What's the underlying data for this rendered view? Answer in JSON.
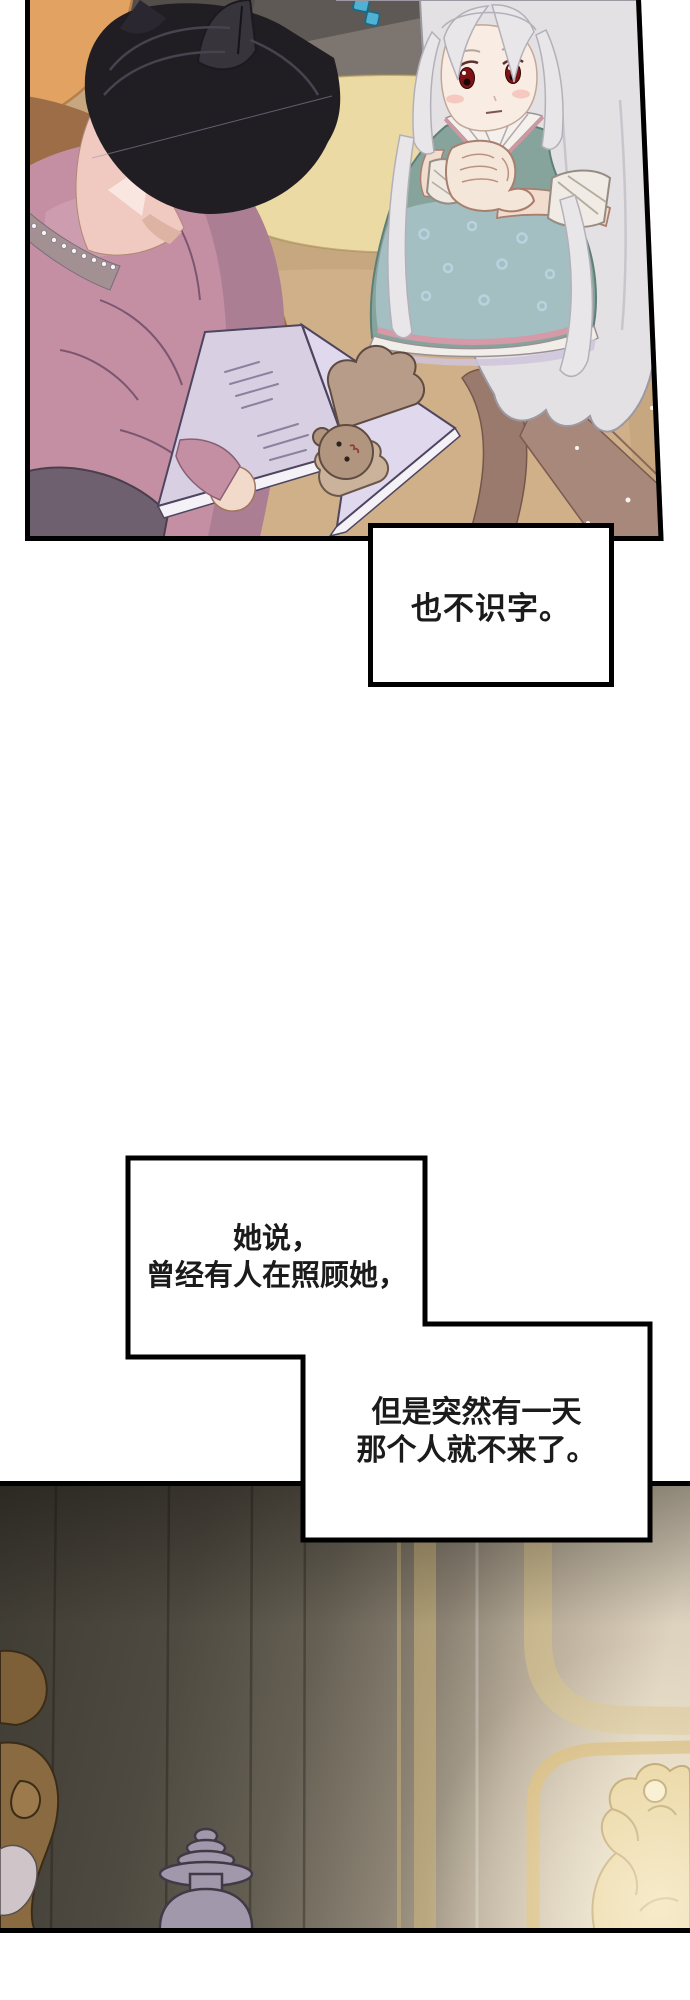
{
  "page": {
    "width": 690,
    "height": 2000,
    "background": "#ffffff"
  },
  "speech_bubbles": {
    "bubble_1": {
      "text": "也不识字。"
    },
    "bubble_2": {
      "line_1": "她说，",
      "line_2": "曾经有人在照顾她，"
    },
    "bubble_3": {
      "line_1": "但是突然有一天",
      "line_2": "那个人就不来了。"
    }
  },
  "palette": {
    "panel_border": "#000000",
    "speech_text": "#1b1b1b",
    "bubble_background": "#ffffff",
    "bed_tan": "#c7a77f",
    "pillow_orange": "#e2a262",
    "pillow_yellow": "#ebdaa3",
    "headboard_gray": "#5f5955",
    "accent_teal_squares": "#4fb2d5",
    "boy_hair_black": "#211e23",
    "boy_sweater_pink": "#c48fa3",
    "pearl_collar_gray": "#a39093",
    "girl_hair_white": "#e3e1e4",
    "girl_eye_red": "#7e1214",
    "girl_dress_teal": "#86a49c",
    "dress_trim_pink": "#cf97a1",
    "book_page_lavender": "#d8cfe3",
    "bear_brown": "#b2957f",
    "wall_dark_olive": "#3e3b33",
    "wall_light_cream": "#ded3bf",
    "gold_trim": "#d2b679",
    "lantern_gray": "#a198ab",
    "furniture_brown": "#8a6a40"
  }
}
